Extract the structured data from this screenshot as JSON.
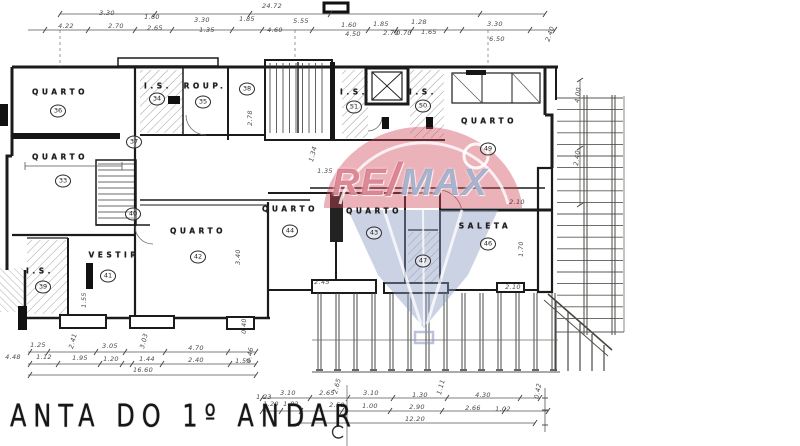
{
  "title": {
    "text": "ANTA DO 1º ANDAR"
  },
  "watermark": {
    "re": "RE",
    "slash": "/",
    "max": "MAX",
    "red": "#c63c52",
    "blue": "#8fa0c8"
  },
  "rooms": [
    {
      "id": "quarto-36",
      "label": "QUARTO",
      "num": "36",
      "lx": 60,
      "ly": 92,
      "cx": 58,
      "cy": 111
    },
    {
      "id": "is-34",
      "label": "I.S.",
      "num": "34",
      "lx": 158,
      "ly": 86,
      "cx": 157,
      "cy": 99
    },
    {
      "id": "roup-35",
      "label": "ROUP.",
      "num": "35",
      "lx": 205,
      "ly": 86,
      "cx": 203,
      "cy": 102
    },
    {
      "id": "stairwell-38",
      "label": "",
      "num": "38",
      "lx": 0,
      "ly": 0,
      "cx": 247,
      "cy": 89
    },
    {
      "id": "is-51",
      "label": "I.S.",
      "num": "51",
      "lx": 354,
      "ly": 92,
      "cx": 354,
      "cy": 107
    },
    {
      "id": "is-50",
      "label": "I.S.",
      "num": "50",
      "lx": 423,
      "ly": 92,
      "cx": 423,
      "cy": 106
    },
    {
      "id": "quarto-49",
      "label": "QUARTO",
      "num": "49",
      "lx": 489,
      "ly": 121,
      "cx": 488,
      "cy": 149
    },
    {
      "id": "quarto-33",
      "label": "QUARTO",
      "num": "33",
      "lx": 60,
      "ly": 157,
      "cx": 63,
      "cy": 181
    },
    {
      "id": "hall-37",
      "label": "",
      "num": "37",
      "lx": 0,
      "ly": 0,
      "cx": 134,
      "cy": 142
    },
    {
      "id": "stair-40",
      "label": "",
      "num": "40",
      "lx": 0,
      "ly": 0,
      "cx": 133,
      "cy": 214
    },
    {
      "id": "is-39",
      "label": "I.S.",
      "num": "39",
      "lx": 40,
      "ly": 271,
      "cx": 43,
      "cy": 287
    },
    {
      "id": "vestir-41",
      "label": "VESTIR",
      "num": "41",
      "lx": 114,
      "ly": 255,
      "cx": 108,
      "cy": 276
    },
    {
      "id": "quarto-42",
      "label": "QUARTO",
      "num": "42",
      "lx": 198,
      "ly": 231,
      "cx": 198,
      "cy": 257
    },
    {
      "id": "quarto-44",
      "label": "QUARTO",
      "num": "44",
      "lx": 290,
      "ly": 209,
      "cx": 290,
      "cy": 231
    },
    {
      "id": "quarto-43",
      "label": "QUARTO",
      "num": "43",
      "lx": 374,
      "ly": 211,
      "cx": 374,
      "cy": 233
    },
    {
      "id": "room-47",
      "label": "",
      "num": "47",
      "lx": 0,
      "ly": 0,
      "cx": 423,
      "cy": 261
    },
    {
      "id": "saleta-46",
      "label": "SALETA",
      "num": "46",
      "lx": 485,
      "ly": 226,
      "cx": 488,
      "cy": 244
    }
  ],
  "dimensions": [
    {
      "t": "4.22",
      "x": 66,
      "y": 26
    },
    {
      "t": "3.30",
      "x": 107,
      "y": 13
    },
    {
      "t": "2.70",
      "x": 116,
      "y": 26
    },
    {
      "t": "1.60",
      "x": 152,
      "y": 17
    },
    {
      "t": "2.65",
      "x": 155,
      "y": 28
    },
    {
      "t": "3.30",
      "x": 202,
      "y": 20
    },
    {
      "t": "1.35",
      "x": 207,
      "y": 30
    },
    {
      "t": "1.85",
      "x": 247,
      "y": 19
    },
    {
      "t": "24.72",
      "x": 272,
      "y": 6
    },
    {
      "t": "4.60",
      "x": 275,
      "y": 30
    },
    {
      "t": "5.55",
      "x": 301,
      "y": 21
    },
    {
      "t": "1.60",
      "x": 349,
      "y": 25
    },
    {
      "t": "4.50",
      "x": 353,
      "y": 34
    },
    {
      "t": "1.85",
      "x": 381,
      "y": 24
    },
    {
      "t": "2.70",
      "x": 391,
      "y": 33
    },
    {
      "t": "0.70",
      "x": 404,
      "y": 33
    },
    {
      "t": "1.28",
      "x": 419,
      "y": 22
    },
    {
      "t": "1.65",
      "x": 429,
      "y": 32
    },
    {
      "t": "3.30",
      "x": 495,
      "y": 24
    },
    {
      "t": "6.50",
      "x": 497,
      "y": 39
    },
    {
      "t": "2.40",
      "x": 550,
      "y": 34,
      "r": -70
    },
    {
      "t": "2.78",
      "x": 250,
      "y": 118,
      "r": -90
    },
    {
      "t": "1.34",
      "x": 313,
      "y": 154,
      "r": -75
    },
    {
      "t": "1.35",
      "x": 325,
      "y": 171
    },
    {
      "t": "2.45",
      "x": 322,
      "y": 282
    },
    {
      "t": "2.10",
      "x": 517,
      "y": 202
    },
    {
      "t": "2.10",
      "x": 513,
      "y": 287
    },
    {
      "t": "1.70",
      "x": 521,
      "y": 249,
      "r": -90
    },
    {
      "t": "4.00",
      "x": 578,
      "y": 95,
      "r": -83
    },
    {
      "t": "2.40",
      "x": 577,
      "y": 158,
      "r": -83
    },
    {
      "t": "3.40",
      "x": 238,
      "y": 257,
      "r": -90
    },
    {
      "t": "1.55",
      "x": 84,
      "y": 300,
      "r": -90
    },
    {
      "t": "0.40",
      "x": 244,
      "y": 326,
      "r": -90
    },
    {
      "t": "1.25",
      "x": 38,
      "y": 345
    },
    {
      "t": "2.41",
      "x": 73,
      "y": 341,
      "r": -75
    },
    {
      "t": "3.05",
      "x": 110,
      "y": 346
    },
    {
      "t": "3.03",
      "x": 144,
      "y": 341,
      "r": -75
    },
    {
      "t": "4.70",
      "x": 196,
      "y": 348
    },
    {
      "t": "4.48",
      "x": 13,
      "y": 357
    },
    {
      "t": "1.12",
      "x": 44,
      "y": 357
    },
    {
      "t": "1.95",
      "x": 80,
      "y": 358
    },
    {
      "t": "1.20",
      "x": 111,
      "y": 359
    },
    {
      "t": "1.44",
      "x": 147,
      "y": 359
    },
    {
      "t": "2.40",
      "x": 196,
      "y": 360
    },
    {
      "t": "1.55",
      "x": 243,
      "y": 361
    },
    {
      "t": "16.60",
      "x": 143,
      "y": 370
    },
    {
      "t": "0.46",
      "x": 250,
      "y": 355,
      "r": -80
    },
    {
      "t": "1.23",
      "x": 264,
      "y": 397
    },
    {
      "t": "3.10",
      "x": 288,
      "y": 393
    },
    {
      "t": "2.65",
      "x": 327,
      "y": 393
    },
    {
      "t": "2.65",
      "x": 337,
      "y": 386,
      "r": -75
    },
    {
      "t": "3.10",
      "x": 371,
      "y": 393
    },
    {
      "t": "1.30",
      "x": 420,
      "y": 395
    },
    {
      "t": "1.11",
      "x": 441,
      "y": 387,
      "r": -75
    },
    {
      "t": "4.30",
      "x": 483,
      "y": 395
    },
    {
      "t": "1.20",
      "x": 271,
      "y": 404
    },
    {
      "t": "1.82",
      "x": 291,
      "y": 404
    },
    {
      "t": "2.50",
      "x": 337,
      "y": 405
    },
    {
      "t": "1.00",
      "x": 370,
      "y": 406
    },
    {
      "t": "2.90",
      "x": 417,
      "y": 407
    },
    {
      "t": "2.66",
      "x": 473,
      "y": 408
    },
    {
      "t": "1.02",
      "x": 503,
      "y": 409
    },
    {
      "t": "12.20",
      "x": 415,
      "y": 419
    },
    {
      "t": "0.42",
      "x": 538,
      "y": 391,
      "r": -80
    }
  ]
}
